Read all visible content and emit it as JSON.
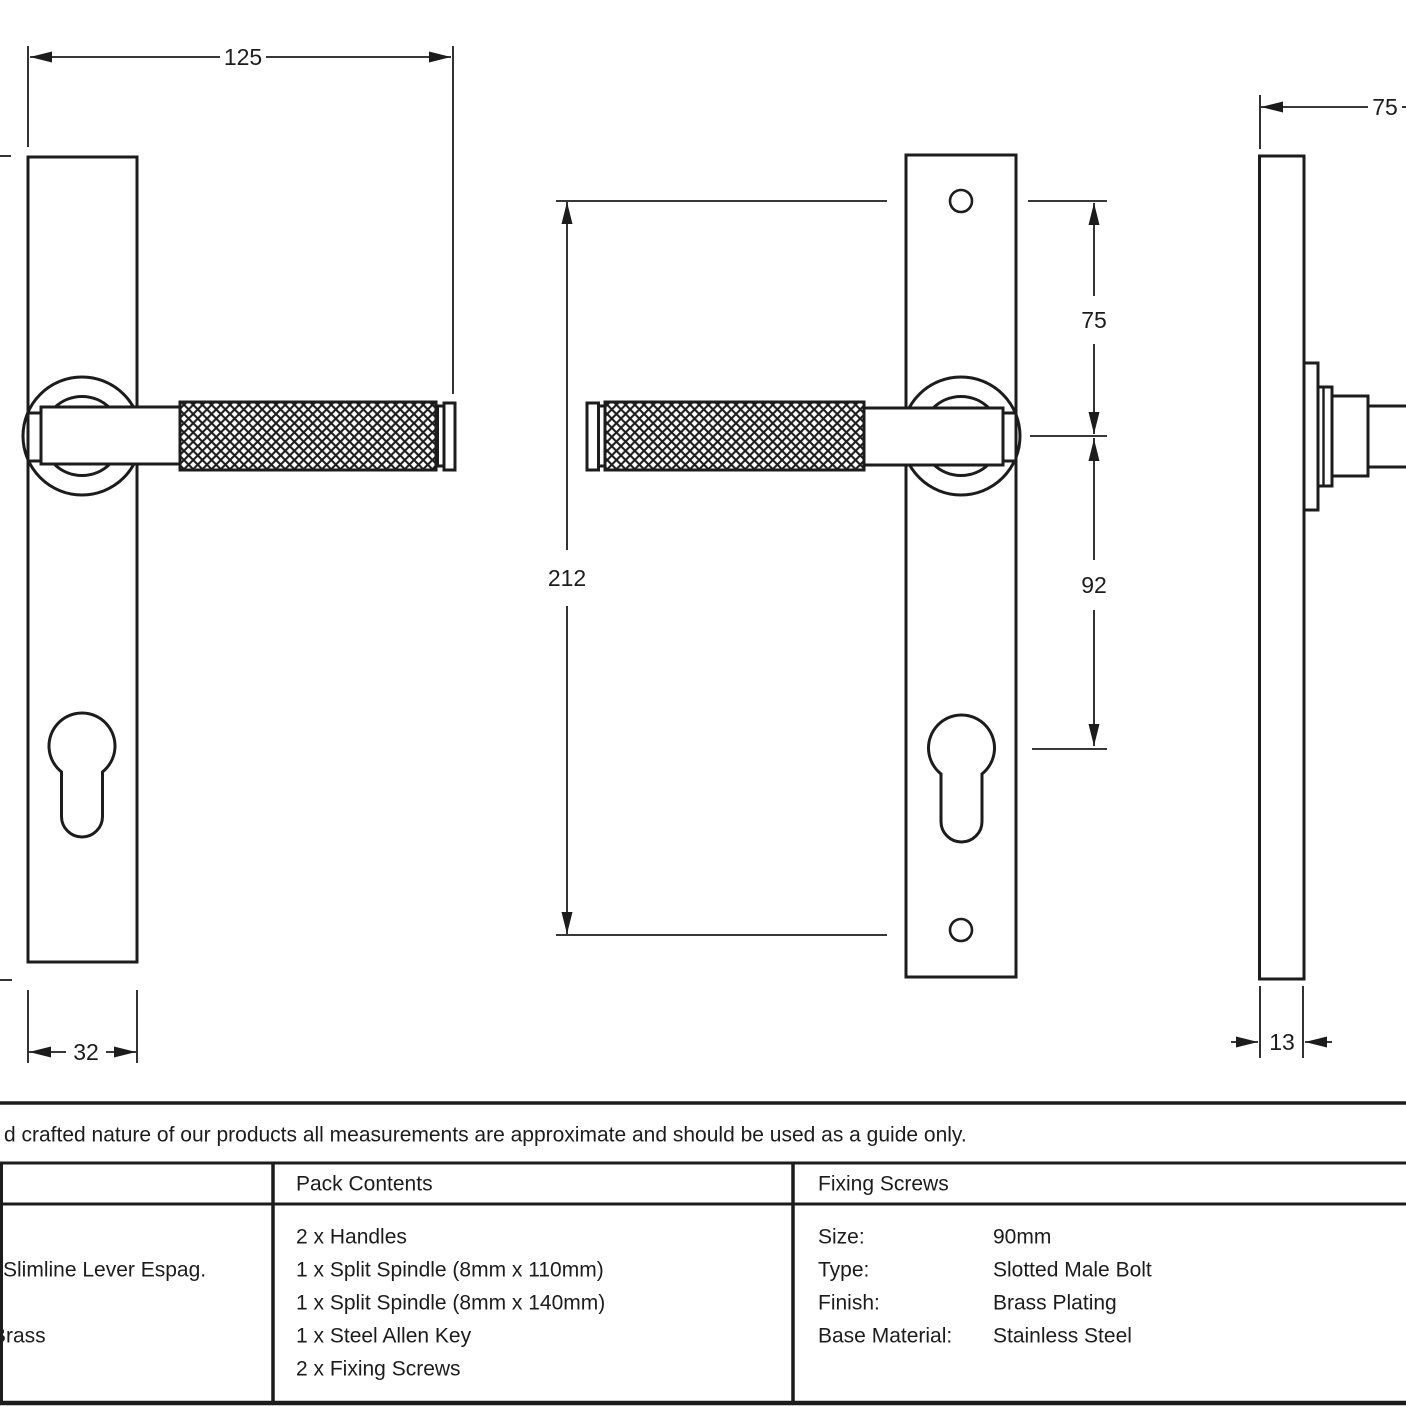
{
  "colors": {
    "ink": "#1c1c1c",
    "bg": "#ffffff"
  },
  "dims": {
    "front_overall_width": "125",
    "backplate_width": "32",
    "backplate_height": "212",
    "top_to_handle_centre": "75",
    "handle_to_cylinder_centre": "92",
    "side_projection": "75",
    "backplate_thickness": "13"
  },
  "disclaimer": "d crafted nature of our products all measurements are approximate and should be used as a guide only.",
  "table": {
    "product": {
      "line1": "Slimline Lever Espag.",
      "line2": "Brass"
    },
    "pack": {
      "header": "Pack Contents",
      "items": [
        "2 x Handles",
        "1 x Split Spindle (8mm x 110mm)",
        "1 x Split Spindle (8mm x 140mm)",
        "1 x Steel Allen Key",
        "2 x Fixing Screws"
      ]
    },
    "fixing": {
      "header": "Fixing Screws",
      "rows": [
        {
          "label": "Size:",
          "value": "90mm"
        },
        {
          "label": "Type:",
          "value": "Slotted Male Bolt"
        },
        {
          "label": "Finish:",
          "value": "Brass Plating"
        },
        {
          "label": "Base Material:",
          "value": "Stainless Steel"
        }
      ]
    }
  }
}
